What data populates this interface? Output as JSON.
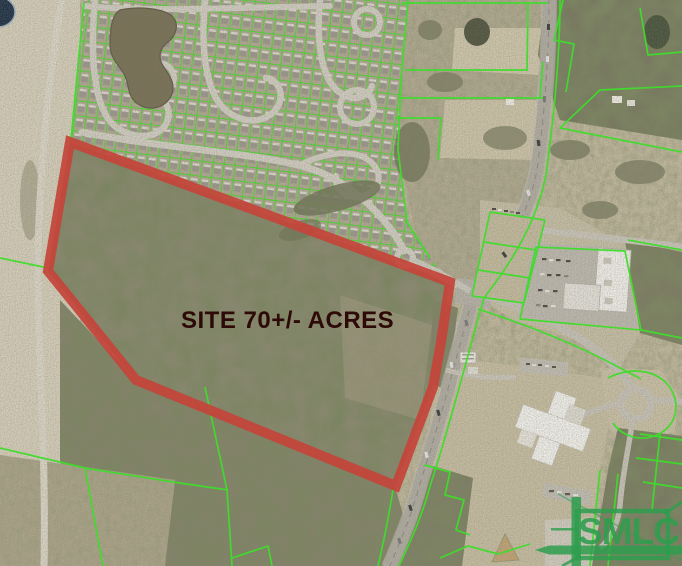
{
  "map": {
    "site_label": "SITE 70+/- ACRES",
    "logo_text": "SMLC",
    "colors": {
      "boundary_red": "#c4443a",
      "parcel_green": "#3fdd2b",
      "logo_green": "#2e9e4e",
      "site_label_color": "#2d0907"
    }
  }
}
